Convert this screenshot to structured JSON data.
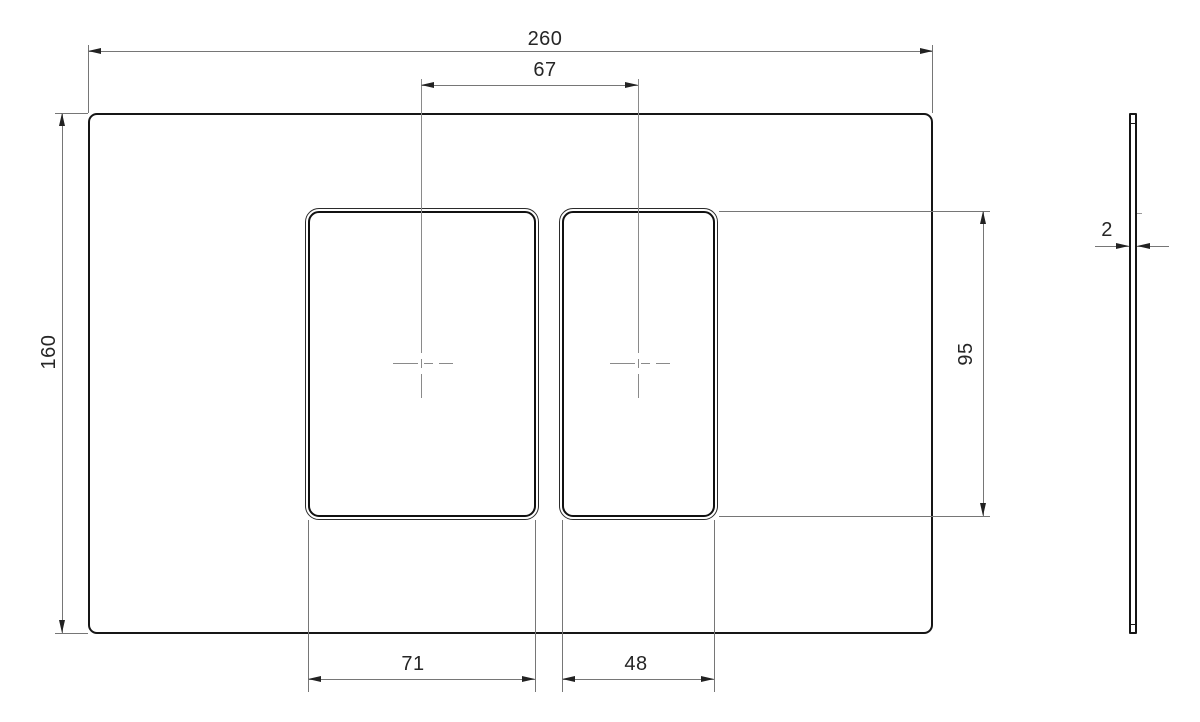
{
  "drawing": {
    "type": "2D engineering drawing, plate with two rounded rectangular cutouts, front view and side view",
    "dimensions": {
      "overall_width": "260",
      "cutout_center_distance": "67",
      "overall_height": "160",
      "cutout_height": "95",
      "left_cutout_width": "71",
      "right_cutout_width": "48",
      "plate_thickness": "2"
    },
    "colors": {
      "background": "#ffffff",
      "outline": "#161616",
      "dimension_line": "#767676",
      "centerline": "#8a8a8a",
      "text": "#262626"
    }
  }
}
